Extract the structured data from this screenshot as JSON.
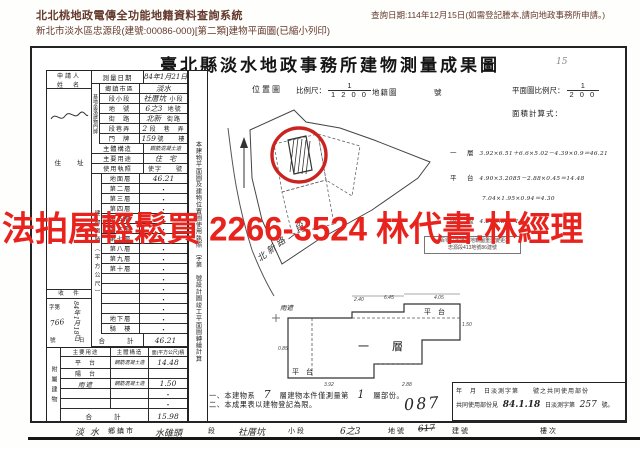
{
  "header": {
    "system_title": "北北桃地政電傳全功能地籍資料查詢系統",
    "subtitle": "新北市淡水區忠源段(建號:00086-000)[第二類]建物平面圖(已縮小列印)",
    "query_date": "查詢日期:114年12月15日(如需登記謄本,請向地政事務所申請。)"
  },
  "watermark": {
    "text": "法拍屋輕鬆買 2266-3524 林代書.林經理",
    "color": "#e8231d"
  },
  "doc": {
    "title": "臺北縣淡水地政事務所建物測量成果圖",
    "title_note": "15",
    "applicant": {
      "label_line1": "申請人",
      "label_line2": "姓　名",
      "address_label": "住　　址"
    },
    "receipt": {
      "title": "收　件",
      "prefix": "字第",
      "date": "84年1月18日",
      "number": "766",
      "suffix": "號",
      "day": "日"
    },
    "survey": {
      "label": "測量日期",
      "value": "84年1月21日"
    },
    "site_strip": "基地坐落建物門牌",
    "site_rows": [
      {
        "label": "鄉鎮市區",
        "value": "淡水",
        "suffix": ""
      },
      {
        "label": "段小段",
        "value": "社厝坑",
        "suffix": "小段"
      },
      {
        "label": "地　號",
        "value": "6之3",
        "suffix": "地號"
      },
      {
        "label": "街　路",
        "value": "北新",
        "suffix": "街路"
      },
      {
        "label": "段巷弄",
        "value": "2",
        "suffix": "段　巷　弄"
      },
      {
        "label": "門　牌",
        "value": "159",
        "suffix": "號　　樓"
      }
    ],
    "structure": {
      "label": "主體構造",
      "value": "鋼筋混凝土造"
    },
    "usage": {
      "label": "主要用途",
      "value": "住　宅"
    },
    "license": {
      "label": "使用執照",
      "value": "使字　　號"
    },
    "area_strip": "建物面積（平方公尺）",
    "floors": [
      {
        "label": "地面層",
        "value": "46.21",
        "hand": true
      },
      {
        "label": "第二層",
        "value": "・"
      },
      {
        "label": "第三層",
        "value": "・"
      },
      {
        "label": "第四層",
        "value": "・"
      },
      {
        "label": "第五層",
        "value": "・"
      },
      {
        "label": "第六層",
        "value": "・"
      },
      {
        "label": "第七層",
        "value": "・"
      },
      {
        "label": "第八層",
        "value": "・"
      },
      {
        "label": "第九層",
        "value": "・"
      },
      {
        "label": "第十層",
        "value": "・"
      },
      {
        "label": "",
        "value": "・"
      },
      {
        "label": "",
        "value": "・"
      },
      {
        "label": "",
        "value": "・"
      },
      {
        "label": "",
        "value": "・"
      },
      {
        "label": "地下層",
        "value": "・"
      },
      {
        "label": "騎　樓",
        "value": "・"
      }
    ],
    "total": {
      "label": "合　　計",
      "value": "46.21"
    },
    "attached": {
      "strip": "附屬建物",
      "header": {
        "use": "主要用途",
        "structure": "主體構造",
        "area": "面(平方公尺)積"
      },
      "rows": [
        {
          "use": "平　台",
          "hand_use": false,
          "structure": "鋼筋混凝土造",
          "area": "14.48"
        },
        {
          "use": "陽　台",
          "hand_use": false,
          "structure": "",
          "area": ""
        },
        {
          "use": "雨遮",
          "hand_use": true,
          "structure": "鋼筋混凝土造",
          "area": "1.50"
        },
        {
          "use": "",
          "hand_use": false,
          "structure": "",
          "area": "・"
        },
        {
          "use": "",
          "hand_use": false,
          "structure": "",
          "area": "・"
        }
      ],
      "total_label": "合　　計",
      "total_value": "15.98"
    },
    "vertical_note": "本建物平面圖及建物位置圖使用執照　字第　號設計圖竣工平面圖轉繪計算",
    "map": {
      "label": "位置圖",
      "scale_label": "比例尺：",
      "scale_num": "1",
      "scale_den": "1 2 0 0",
      "ref": "地籍圖",
      "no": "號",
      "road": "北新路二段"
    },
    "plan_scale": {
      "label": "平面圖比例尺：",
      "num": "1",
      "den": "2 0 0",
      "calc_label": "面積計算式："
    },
    "formulas": [
      {
        "label": "一　層",
        "text": "3.92×6.51＋6.6×5.02－4.39×0.9＝46.21"
      },
      {
        "label": "平　台",
        "text": "4.90×3.2085－2.88×0.45＝14.48"
      },
      {
        "label": "",
        "text": "7.04×1.95×0.94＝4.30"
      },
      {
        "label": "雨　遮",
        "text": "4.2×0.36＝1.50"
      }
    ],
    "stamp": {
      "line1": "一百零八年度因地籍圖重測變更為",
      "line2": "忠源段413地號86建號"
    },
    "plan": {
      "rain": "雨遮",
      "platform_top": "平　台",
      "first_floor": "一　層",
      "platform_bottom": "平　台",
      "dims": [
        "2.40",
        "6.45",
        "4.05",
        "1.50",
        "0.85",
        "3.92",
        "2.88"
      ]
    },
    "notes": {
      "n1_pre": "一、本建物系",
      "n1_hand1": "7",
      "n1_mid": "層建物本件僅測量第",
      "n1_hand2": "1",
      "n1_post": "層部份。",
      "n2": "二、本成果表以建物登記為限。",
      "hand_no": "087"
    },
    "common": {
      "row1": "年　月　日淡測字第　　號之共同使用部份",
      "row2_pre": "共同使用部份見",
      "row2_hand1": "84.1.18",
      "row2_mid": "日淡測字第",
      "row2_hand2": "257",
      "row2_post": "號。"
    },
    "bottom": {
      "town_hand": "淡水",
      "town": "鄉鎮市",
      "sec_hand": "水碓頭",
      "sec": "段",
      "subsec_hand": "社厝坑",
      "subsec": "小段",
      "lot_hand": "6之3",
      "lot": "地號",
      "bno_hand": "617",
      "bno": "建號",
      "floor": "樓次"
    }
  }
}
